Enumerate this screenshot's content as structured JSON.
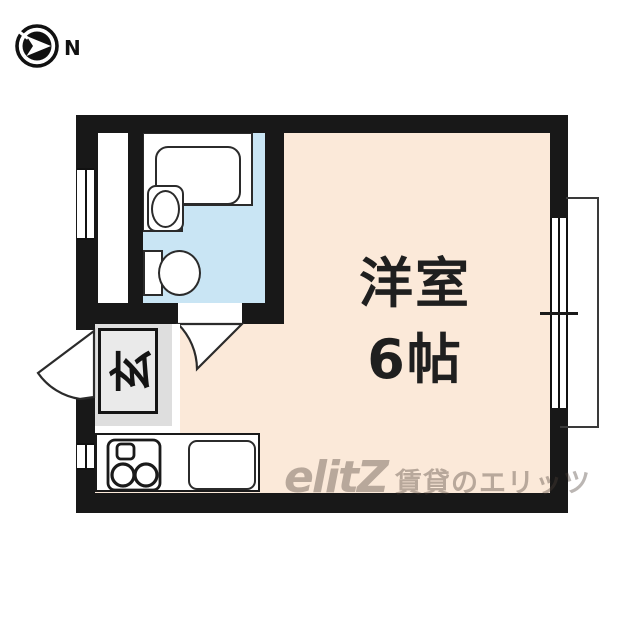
{
  "compass": {
    "label": "N",
    "direction": "north-pointing-right"
  },
  "floorplan": {
    "rooms": {
      "main_room": {
        "name": "洋室",
        "size": "6帖",
        "label": "洋室\n6帖",
        "floor_color": "#fbe9d9"
      },
      "entrance": {
        "label": "玄",
        "floor_color": "#dedede"
      },
      "bathroom": {
        "floor_color": "#c9e5f4",
        "fixtures": [
          "bathtub",
          "washbasin",
          "toilet"
        ]
      },
      "kitchen": {
        "fixtures": [
          "two-burner-stove",
          "kitchen-sink"
        ]
      }
    },
    "colors": {
      "wall": "#181818",
      "room_floor": "#fbe9d9",
      "bath_floor": "#c9e5f4",
      "genkan_floor": "#dedede",
      "fixture_stroke": "#2b2b2b"
    }
  },
  "watermark": {
    "logo": "elitZ",
    "text": "賃貸のエリッツ"
  }
}
